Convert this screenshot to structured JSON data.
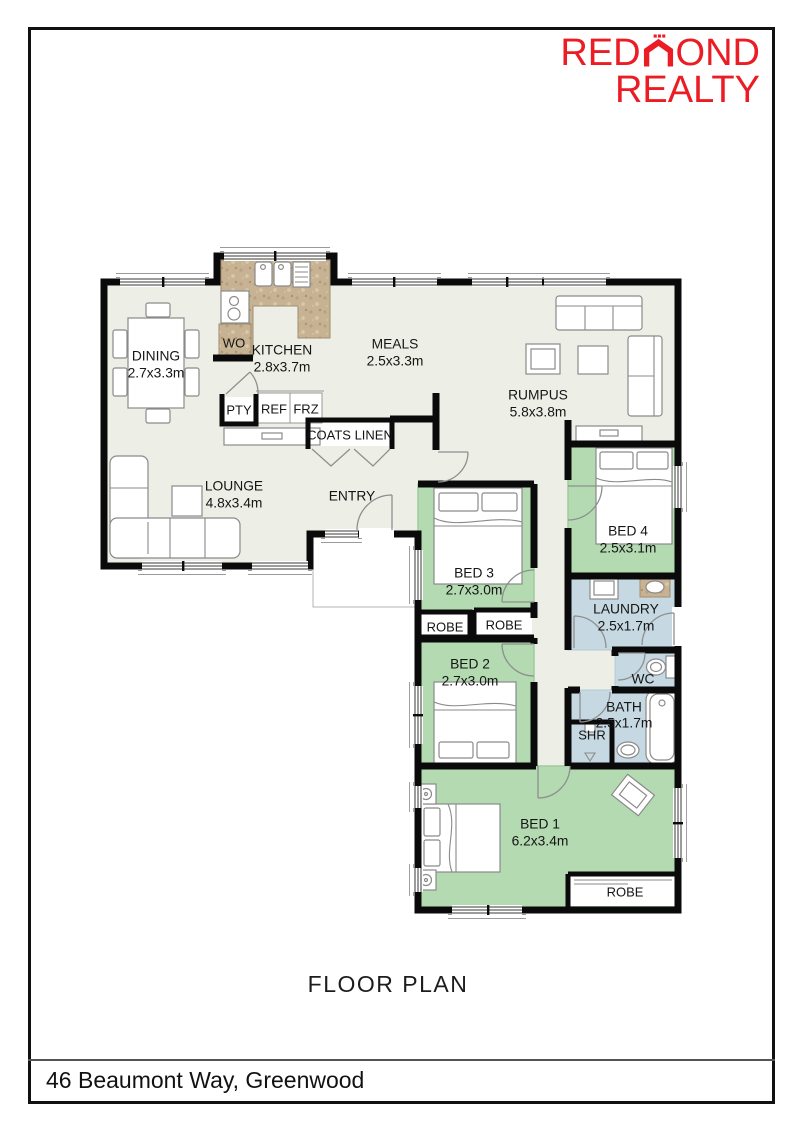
{
  "logo": {
    "pre": "RED",
    "post": "OND",
    "line2": "REALTY",
    "color": "#ec1c24"
  },
  "footer": {
    "title": "FLOOR PLAN",
    "address": "46 Beaumont Way, Greenwood"
  },
  "rooms": {
    "dining": {
      "name": "DINING",
      "dims": "2.7x3.3m"
    },
    "kitchen": {
      "name": "KITCHEN",
      "dims": "2.8x3.7m"
    },
    "meals": {
      "name": "MEALS",
      "dims": "2.5x3.3m"
    },
    "rumpus": {
      "name": "RUMPUS",
      "dims": "5.8x3.8m"
    },
    "lounge": {
      "name": "LOUNGE",
      "dims": "4.8x3.4m"
    },
    "entry": {
      "name": "ENTRY"
    },
    "bed1": {
      "name": "BED 1",
      "dims": "6.2x3.4m"
    },
    "bed2": {
      "name": "BED 2",
      "dims": "2.7x3.0m"
    },
    "bed3": {
      "name": "BED 3",
      "dims": "2.7x3.0m"
    },
    "bed4": {
      "name": "BED 4",
      "dims": "2.5x3.1m"
    },
    "laundry": {
      "name": "LAUNDRY",
      "dims": "2.5x1.7m"
    },
    "bath": {
      "name": "BATH",
      "dims": "2.5x1.7m"
    },
    "wc": {
      "name": "WC"
    },
    "shower": {
      "name": "SHR"
    }
  },
  "closets": {
    "coats_linen": "COATS LINEN",
    "robe": "ROBE",
    "pantry": "PTY",
    "fridge": "REF",
    "freezer": "FRZ",
    "wall_oven": "WO"
  },
  "colors": {
    "bedroom_green": "#b3dab1",
    "wet_area_blue": "#c6d9e2",
    "floor": "#edefe7",
    "counter_tan": "#c8b294",
    "wall": "#0a0a0a",
    "logo_red": "#ec1c24"
  }
}
